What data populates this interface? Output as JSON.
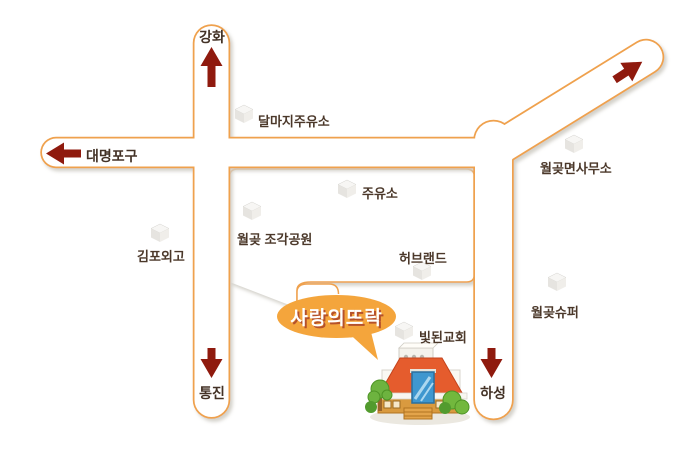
{
  "bubble": {
    "label": "사랑의뜨락"
  },
  "endpoints": {
    "top": {
      "label": "강화",
      "direction": "up"
    },
    "left": {
      "label": "대명포구",
      "direction": "left"
    },
    "bottom_left": {
      "label": "통진",
      "direction": "down"
    },
    "bottom_right": {
      "label": "하성",
      "direction": "down"
    },
    "top_right": {
      "label": "",
      "direction": "up-right"
    }
  },
  "landmarks": [
    {
      "label": "달마지주유소"
    },
    {
      "label": "주유소"
    },
    {
      "label": "월곶 조각공원"
    },
    {
      "label": "허브랜드"
    },
    {
      "label": "월곶면사무소"
    },
    {
      "label": "월곶슈퍼"
    },
    {
      "label": "빛된교회"
    },
    {
      "label": "김포외고"
    }
  ],
  "colors": {
    "road_border": "#EFA14E",
    "arrow": "#8F1A0E",
    "bubble_bg": "#F4A53C",
    "bubble_text": "#FFFFFF",
    "label_text": "#4B382A",
    "shadow": "#CFCCC4"
  }
}
